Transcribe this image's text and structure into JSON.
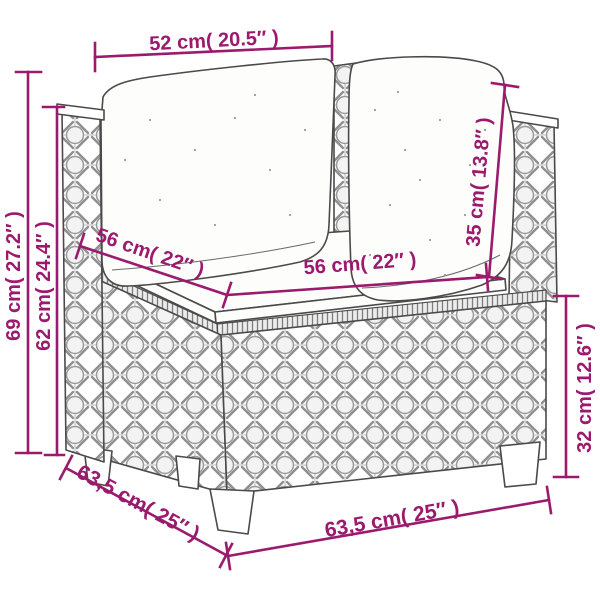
{
  "diagram": {
    "subject": "poly rattan corner sofa section with back pillows and seat cushion",
    "accent_color": "#9B1A6E",
    "outline_color": "#4A4A4A",
    "background_color": "#FFFFFF",
    "measurements": {
      "pillow_width_top": {
        "label": "52 cm( 20.5″ )",
        "cm": 52,
        "inch": 20.5,
        "orientation": "horizontal-top"
      },
      "total_height": {
        "label": "69 cm( 27.2″ )",
        "cm": 69,
        "inch": 27.2,
        "orientation": "vertical-left-outer"
      },
      "arm_height": {
        "label": "62 cm( 24.4″ )",
        "cm": 62,
        "inch": 24.4,
        "orientation": "vertical-left-inner"
      },
      "seat_depth": {
        "label": "56 cm( 22″ )",
        "cm": 56,
        "inch": 22,
        "orientation": "diagonal-seat-left"
      },
      "seat_width": {
        "label": "56 cm( 22″ )",
        "cm": 56,
        "inch": 22,
        "orientation": "diagonal-seat-right"
      },
      "back_cushion_height": {
        "label": "35 cm( 13.8″ )",
        "cm": 35,
        "inch": 13.8,
        "orientation": "diagonal-back-right"
      },
      "base_height": {
        "label": "32 cm( 12.6″ )",
        "cm": 32,
        "inch": 12.6,
        "orientation": "vertical-right"
      },
      "base_depth": {
        "label": "63,5 cm( 25″ )",
        "cm": 63.5,
        "inch": 25,
        "orientation": "diagonal-bottom-left"
      },
      "base_width": {
        "label": "63,5 cm( 25″ )",
        "cm": 63.5,
        "inch": 25,
        "orientation": "diagonal-bottom-right"
      }
    }
  }
}
